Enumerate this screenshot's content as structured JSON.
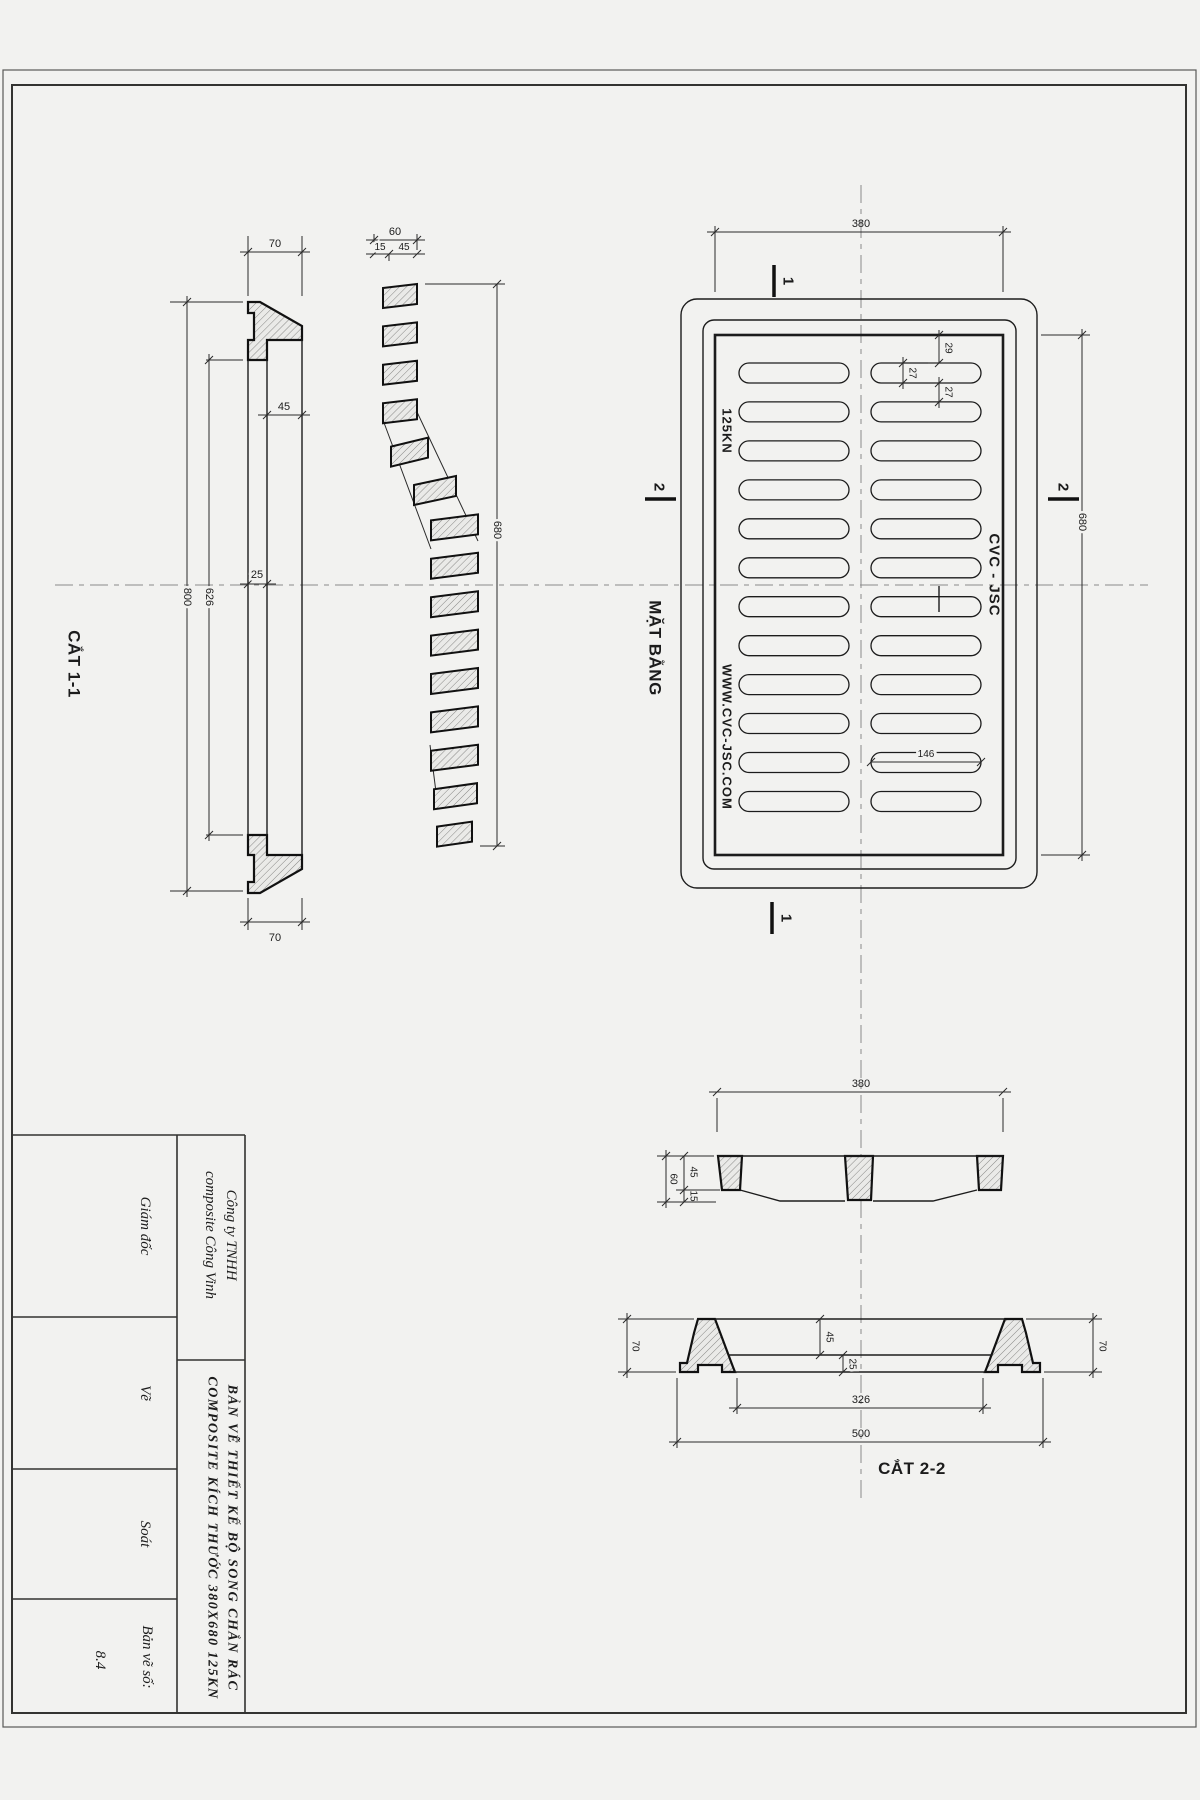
{
  "drawing": {
    "sections": {
      "cat11_label": "CẮT 1-1",
      "plan_label": "MẶT BẰNG",
      "cat22_label": "CẮT 2-2",
      "marker1_top": "1",
      "marker1_bottom": "1",
      "marker2_left": "2",
      "marker2_right": "2"
    },
    "plan_markings": {
      "load": "125KN",
      "brand": "CVC - JSC",
      "website": "WWW.CVC-JSC.COM"
    },
    "dims": {
      "cat11": {
        "top_width": "70",
        "bottom_width": "70",
        "seat": "45",
        "wall": "25",
        "inner_len": "626",
        "outer_len": "800"
      },
      "lid_side": {
        "total_depth": "60",
        "lip": "15",
        "bar_depth": "45",
        "length": "680"
      },
      "plan": {
        "width": "380",
        "length": "680",
        "edge_gap": "29",
        "slot_w": "27",
        "slot_gap": "27",
        "slot_len": "146"
      },
      "cat22": {
        "width": "380",
        "total_depth": "60",
        "bar_depth": "45",
        "lip": "15",
        "frame_h_left": "70",
        "frame_h_right": "70",
        "seat": "45",
        "base": "25",
        "inner_w": "326",
        "outer_w": "500"
      }
    }
  },
  "title_block": {
    "company_line1": "Công ty TNHH",
    "company_line2": "composite Công Vinh",
    "role_director": "Giám đốc",
    "role_drawn": "Vẽ",
    "role_checked": "Soát",
    "title_line1": "BẢN VẼ THIẾT KẾ BỘ SONG CHẮN RÁC",
    "title_line2": "COMPOSITE KÍCH THƯỚC 380X680  125KN",
    "number_label": "Bản vẽ số:",
    "number_value": "8.4"
  }
}
